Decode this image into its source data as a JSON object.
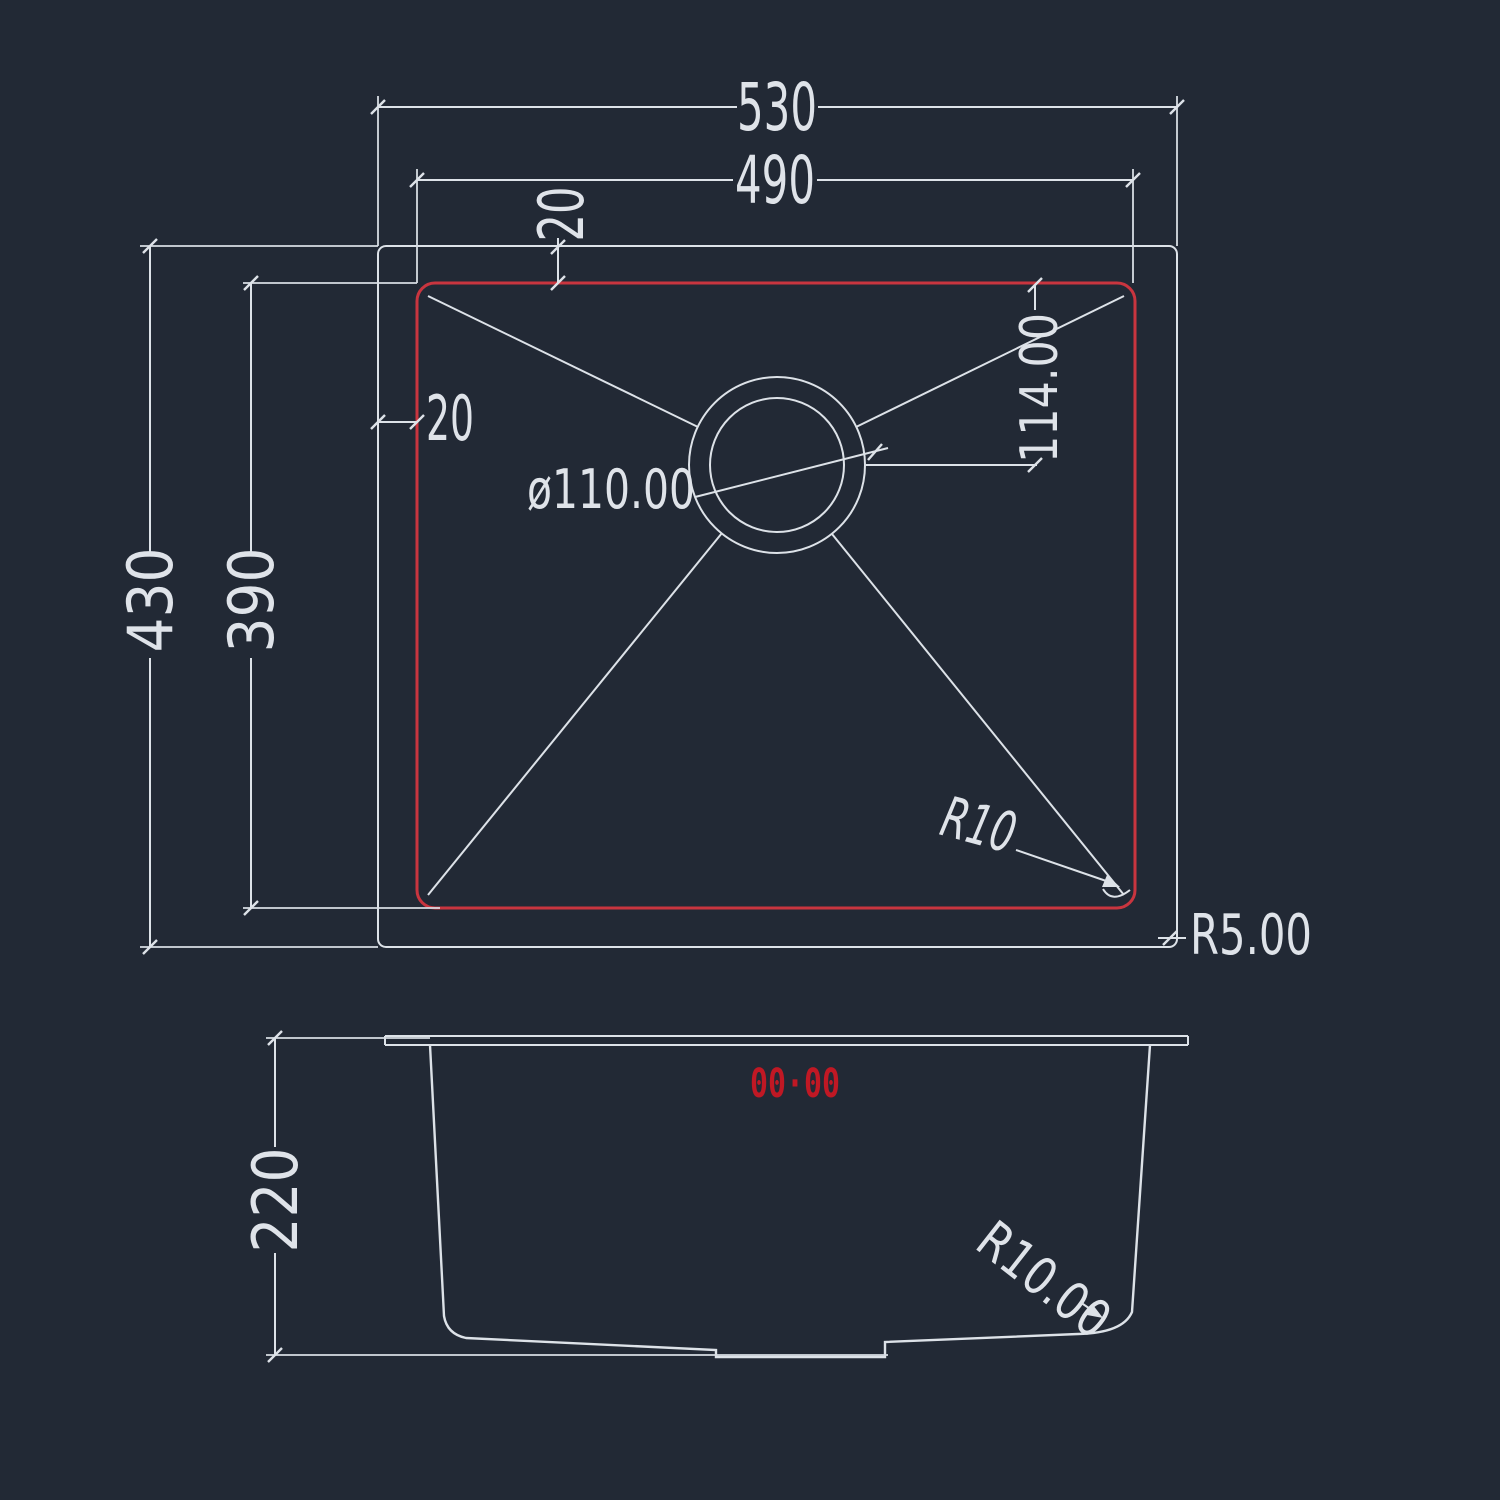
{
  "meta": {
    "description": "CAD technical drawing of a single-bowl kitchen sink, top view and section view"
  },
  "colors": {
    "background": "#222935",
    "line": "#dde2e8",
    "accent_red": "#c9353f",
    "marking_red": "#c01824"
  },
  "top_view": {
    "dim_overall_width": "530",
    "dim_bowl_width": "490",
    "dim_top_offset": "20",
    "dim_left_offset": "20",
    "dim_overall_depth": "430",
    "dim_bowl_depth": "390",
    "dim_drain_diameter": "ø110.00",
    "dim_drain_offset": "114.00",
    "dim_bowl_corner_radius": "R10",
    "dim_outer_corner_radius": "R5.00"
  },
  "section_view": {
    "dim_bowl_height": "220",
    "dim_bottom_corner_radius": "R10.00",
    "marking": "00·00"
  }
}
